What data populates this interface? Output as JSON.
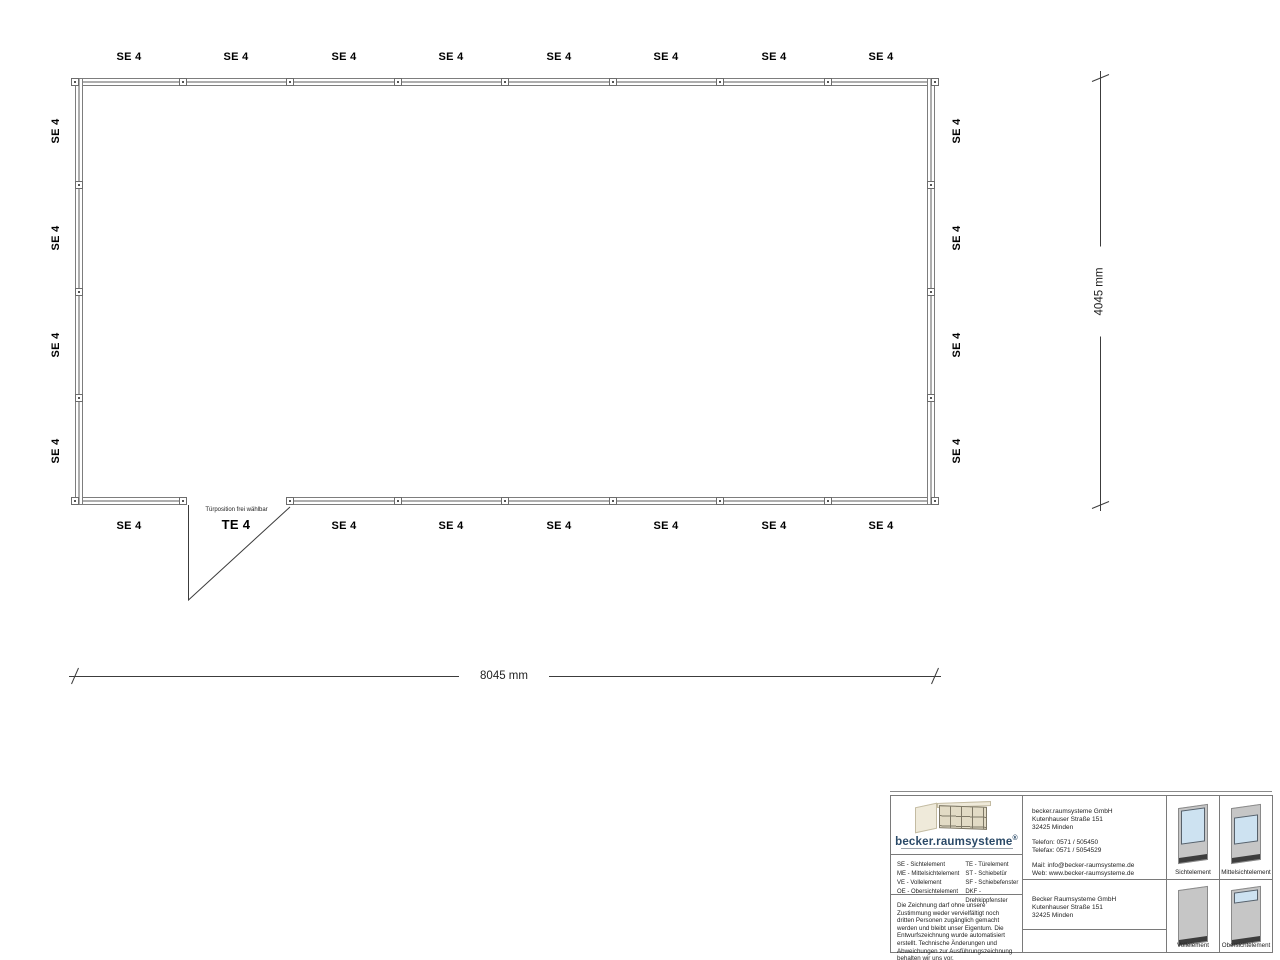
{
  "plan": {
    "top_labels": [
      "SE 4",
      "SE 4",
      "SE 4",
      "SE 4",
      "SE 4",
      "SE 4",
      "SE 4",
      "SE 4"
    ],
    "bottom_labels": [
      "SE 4",
      "TE 4",
      "SE 4",
      "SE 4",
      "SE 4",
      "SE 4",
      "SE 4",
      "SE 4"
    ],
    "left_labels": [
      "SE 4",
      "SE 4",
      "SE 4",
      "SE 4"
    ],
    "right_labels": [
      "SE 4",
      "SE 4",
      "SE 4",
      "SE 4"
    ],
    "door_note": "Türposition frei wählbar",
    "dimensions": {
      "width": "8045 mm",
      "height": "4045 mm"
    }
  },
  "title_block": {
    "logo": {
      "wordmark": "becker.raumsysteme",
      "registered_mark": "®"
    },
    "legend": {
      "col1": [
        "SE - Sichtelement",
        "ME - Mittelsichtelement",
        "VE - Vollelement",
        "OE - Obersichtelement"
      ],
      "col2": [
        "TE - Türelement",
        "ST - Schiebetür",
        "SF - Schiebefenster",
        "DKF - Drehkippfenster"
      ]
    },
    "disclaimer": "Die Zeichnung darf ohne unsere Zustimmung weder vervielfältigt noch dritten Personen zugänglich gemacht werden und bleibt unser Eigentum. Die Entwurfszeichnung wurde automatisiert erstellt. Technische Änderungen und Abweichungen zur Ausführungszeichnung behalten wir uns vor.",
    "company_primary": {
      "name": "becker.raumsysteme GmbH",
      "street": "Kutenhauser Straße 151",
      "city": "32425 Minden",
      "phone": "Telefon: 0571 / 505450",
      "fax": "Telefax: 0571 / 5054529",
      "mail": "Mail: info@becker-raumsysteme.de",
      "web": "Web: www.becker-raumsysteme.de"
    },
    "company_secondary": {
      "name": "Becker Raumsysteme GmbH",
      "street": "Kutenhauser Straße 151",
      "city": "32425 Minden"
    },
    "pictograms": [
      "Sichtelement",
      "Mittelsichtelement",
      "Vollelement",
      "Obersichtelement"
    ]
  },
  "colors": {
    "wall_line": "#7d7d7d",
    "dimension_line": "#3c3c3c",
    "label_text": "#000000",
    "logo_navy": "#2b4a68",
    "sketch_beige": "#e7e1cd",
    "panel_gray": "#c6c6c6",
    "glass_blue": "#cde2f1",
    "panel_base": "#3d3d3d"
  }
}
